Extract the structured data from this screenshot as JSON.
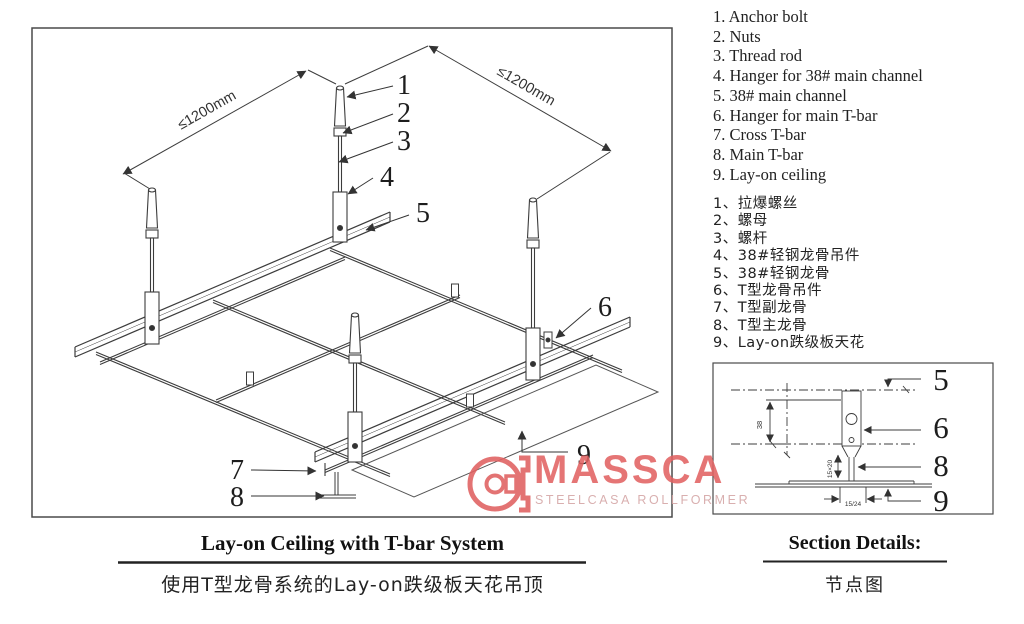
{
  "page": {
    "background": "#ffffff",
    "line_color": "#3c3c3c"
  },
  "legend_en": {
    "items": [
      "1. Anchor bolt",
      "2. Nuts",
      "3. Thread rod",
      "4. Hanger for 38# main channel",
      "5. 38# main channel",
      "6. Hanger for main T-bar",
      "7. Cross T-bar",
      "8. Main T-bar",
      "9. Lay-on ceiling"
    ]
  },
  "legend_zh": {
    "items": [
      "1、拉爆螺丝",
      "2、螺母",
      "3、螺杆",
      "4、38#轻钢龙骨吊件",
      "5、38#轻钢龙骨",
      "6、T型龙骨吊件",
      "7、T型副龙骨",
      "8、T型主龙骨",
      "9、Lay-on跌级板天花"
    ]
  },
  "diagram": {
    "dim_left": "≤1200mm",
    "dim_right": "≤1200mm",
    "callouts": [
      "1",
      "2",
      "3",
      "4",
      "5",
      "6",
      "7",
      "8",
      "9"
    ]
  },
  "section": {
    "callouts": [
      "5",
      "6",
      "8",
      "9"
    ],
    "dim_height": "38",
    "dim_stem": "15×20",
    "dim_width": "15/24",
    "title": "Section Details:",
    "subtitle": "节点图"
  },
  "titles": {
    "main_en": "Lay-on Ceiling with T-bar System",
    "main_zh": "使用T型龙骨系统的Lay-on跌级板天花吊顶"
  },
  "logo": {
    "name": "MASSCA",
    "tagline": "STEELCASA ROLLFORMER",
    "accent": "#e06060",
    "tagline_color": "#d4a5a5"
  }
}
